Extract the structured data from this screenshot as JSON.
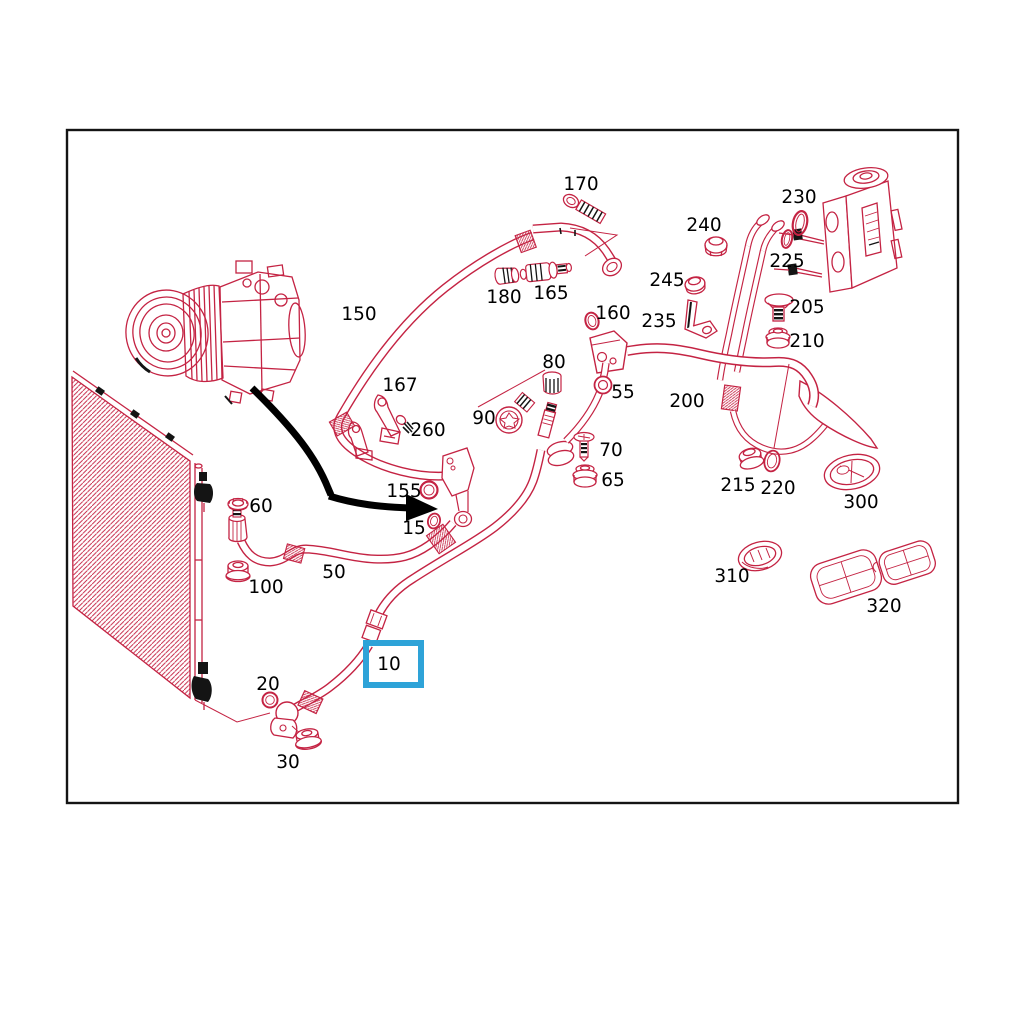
{
  "diagram": {
    "kind": "exploded-parts-diagram",
    "line_color": "#c42343",
    "black_color": "#141414",
    "background": "#ffffff",
    "highlight": {
      "part": "10",
      "color": "#2ea3d8",
      "stroke_width": 6,
      "box": {
        "x": 366,
        "y": 643,
        "width": 55,
        "height": 42
      }
    },
    "part_labels": [
      {
        "text": "170",
        "x": 581,
        "y": 190
      },
      {
        "text": "230",
        "x": 799,
        "y": 203
      },
      {
        "text": "240",
        "x": 704,
        "y": 231
      },
      {
        "text": "225",
        "x": 787,
        "y": 267
      },
      {
        "text": "245",
        "x": 667,
        "y": 286
      },
      {
        "text": "205",
        "x": 807,
        "y": 313
      },
      {
        "text": "235",
        "x": 659,
        "y": 327
      },
      {
        "text": "210",
        "x": 807,
        "y": 347
      },
      {
        "text": "180",
        "x": 504,
        "y": 303
      },
      {
        "text": "165",
        "x": 551,
        "y": 299
      },
      {
        "text": "160",
        "x": 613,
        "y": 319
      },
      {
        "text": "150",
        "x": 359,
        "y": 320
      },
      {
        "text": "167",
        "x": 400,
        "y": 391
      },
      {
        "text": "260",
        "x": 428,
        "y": 436
      },
      {
        "text": "80",
        "x": 554,
        "y": 368
      },
      {
        "text": "55",
        "x": 623,
        "y": 398
      },
      {
        "text": "90",
        "x": 484,
        "y": 424
      },
      {
        "text": "70",
        "x": 611,
        "y": 456
      },
      {
        "text": "65",
        "x": 613,
        "y": 486
      },
      {
        "text": "200",
        "x": 687,
        "y": 407
      },
      {
        "text": "215",
        "x": 738,
        "y": 491
      },
      {
        "text": "220",
        "x": 778,
        "y": 494
      },
      {
        "text": "300",
        "x": 861,
        "y": 508
      },
      {
        "text": "310",
        "x": 732,
        "y": 582
      },
      {
        "text": "320",
        "x": 884,
        "y": 612
      },
      {
        "text": "155",
        "x": 404,
        "y": 497
      },
      {
        "text": "15",
        "x": 414,
        "y": 534
      },
      {
        "text": "60",
        "x": 261,
        "y": 512
      },
      {
        "text": "100",
        "x": 266,
        "y": 593
      },
      {
        "text": "50",
        "x": 334,
        "y": 578
      },
      {
        "text": "20",
        "x": 268,
        "y": 690
      },
      {
        "text": "30",
        "x": 288,
        "y": 768
      },
      {
        "text": "10",
        "x": 389,
        "y": 670
      }
    ]
  }
}
